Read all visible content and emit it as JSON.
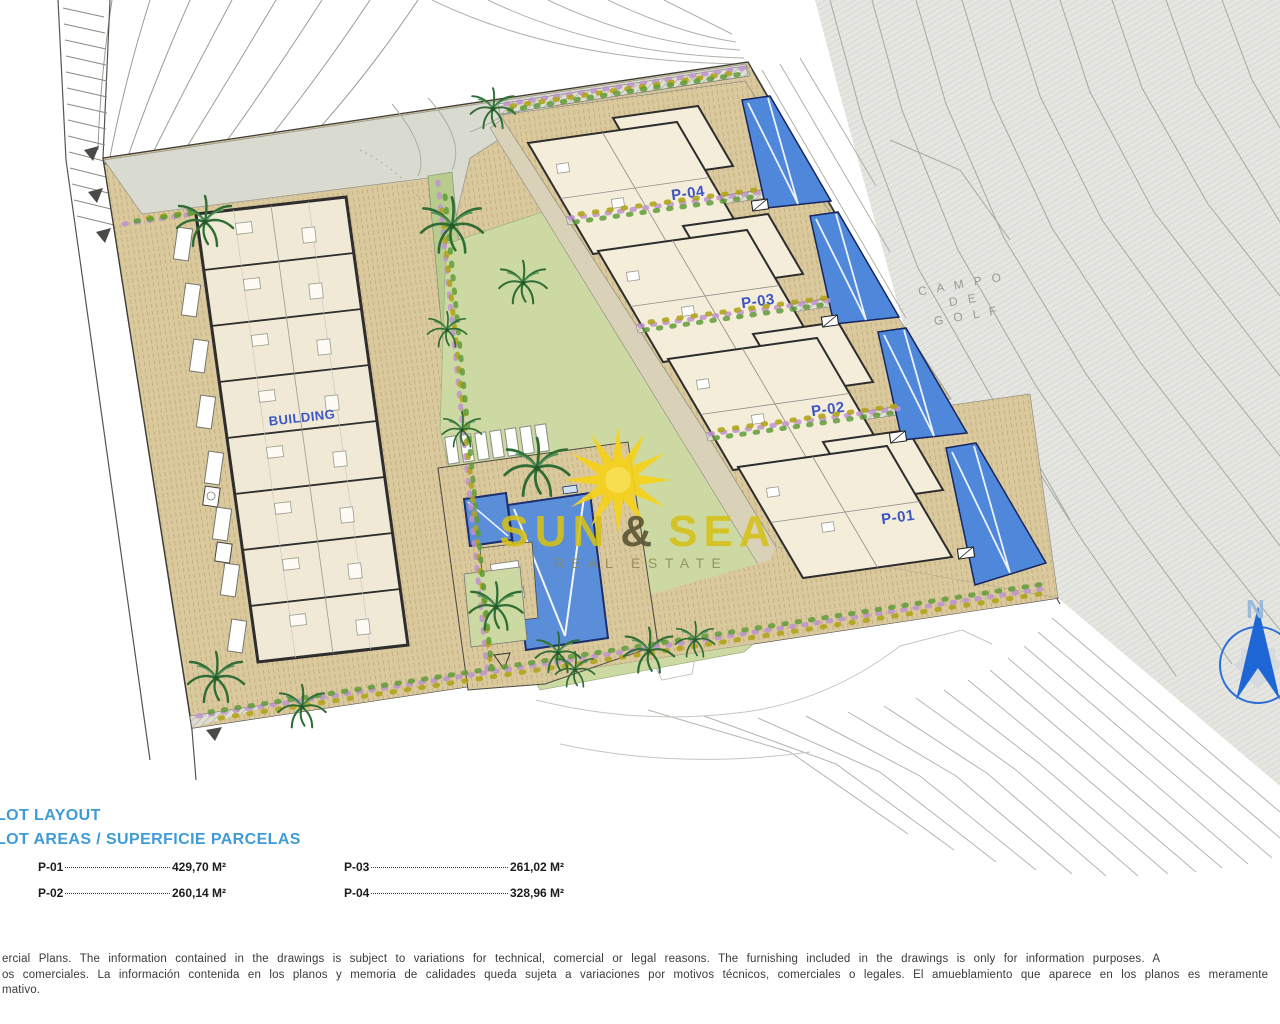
{
  "plan": {
    "building_label": "BUILDING",
    "plot_labels": {
      "p04": "P-04",
      "p03": "P-03",
      "p02": "P-02",
      "p01": "P-01"
    },
    "golf_text": {
      "line1": "C A M P O",
      "line2": "D E",
      "line3": "G O L F"
    },
    "compass_label": "N"
  },
  "watermark": {
    "sun_word": "SUN",
    "ampersand": "&",
    "sea_word": "SEA",
    "subtitle": "REAL ESTATE"
  },
  "legend": {
    "title_line1": "LOT LAYOUT",
    "title_line2": "LOT AREAS / SUPERFICIE PARCELAS",
    "entries": [
      {
        "label": "P-01",
        "value": "429,70 M²"
      },
      {
        "label": "P-02",
        "value": "260,14 M²"
      },
      {
        "label": "P-03",
        "value": "261,02 M²"
      },
      {
        "label": "P-04",
        "value": "328,96 M²"
      }
    ]
  },
  "disclaimer": {
    "line1": "ercial Plans. The information contained in the drawings is subject to variations for technical, comercial or legal reasons. The furnishing included in the drawings is only for information purposes. A",
    "line2": "os comerciales. La información contenida en los planos y memoria de calidades queda sujeta a variaciones por motivos técnicos, comerciales o legales. El amueblamiento que aparece en los planos es meramente",
    "line3": "mativo."
  },
  "colors": {
    "accent_blue": "#3f9bd8",
    "plot_label_blue": "#3d56c4",
    "pool_blue": "#4f87da",
    "lawn_green": "#ccd9a2",
    "paving_tan": "#d8c69b",
    "golf_gray": "#e4e4e0",
    "sun_yellow": "#f2cf1d"
  }
}
